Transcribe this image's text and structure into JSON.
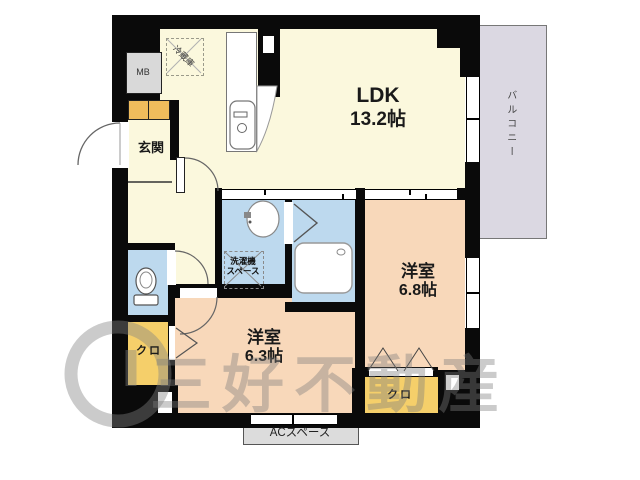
{
  "watermark": {
    "company": "三好不動産"
  },
  "rooms": {
    "ldk": {
      "name": "LDK",
      "size": "13.2帖"
    },
    "bedroom_right": {
      "name": "洋室",
      "size": "6.8帖"
    },
    "bedroom_bottom": {
      "name": "洋室",
      "size": "6.3帖"
    },
    "entrance": {
      "name": "玄関"
    },
    "balcony": {
      "name": "バルコニー"
    }
  },
  "features": {
    "meter_box": "MB",
    "refrigerator": "冷蔵庫",
    "washer_line1": "洗濯機",
    "washer_line2": "スペース",
    "closet_left": "クロ",
    "closet_right": "クロ",
    "ac_space": "ACスペース"
  },
  "colors": {
    "wall": "#0a0a0a",
    "living": "#fbf8dd",
    "bedroom": "#f8d8ba",
    "wet": "#bdd9ee",
    "closet": "#f5cf6a",
    "cabinet": "#f0bc5c",
    "balcony": "#dbd8e2",
    "service": "#dcdcdc",
    "mb": "#d9d9d9"
  }
}
